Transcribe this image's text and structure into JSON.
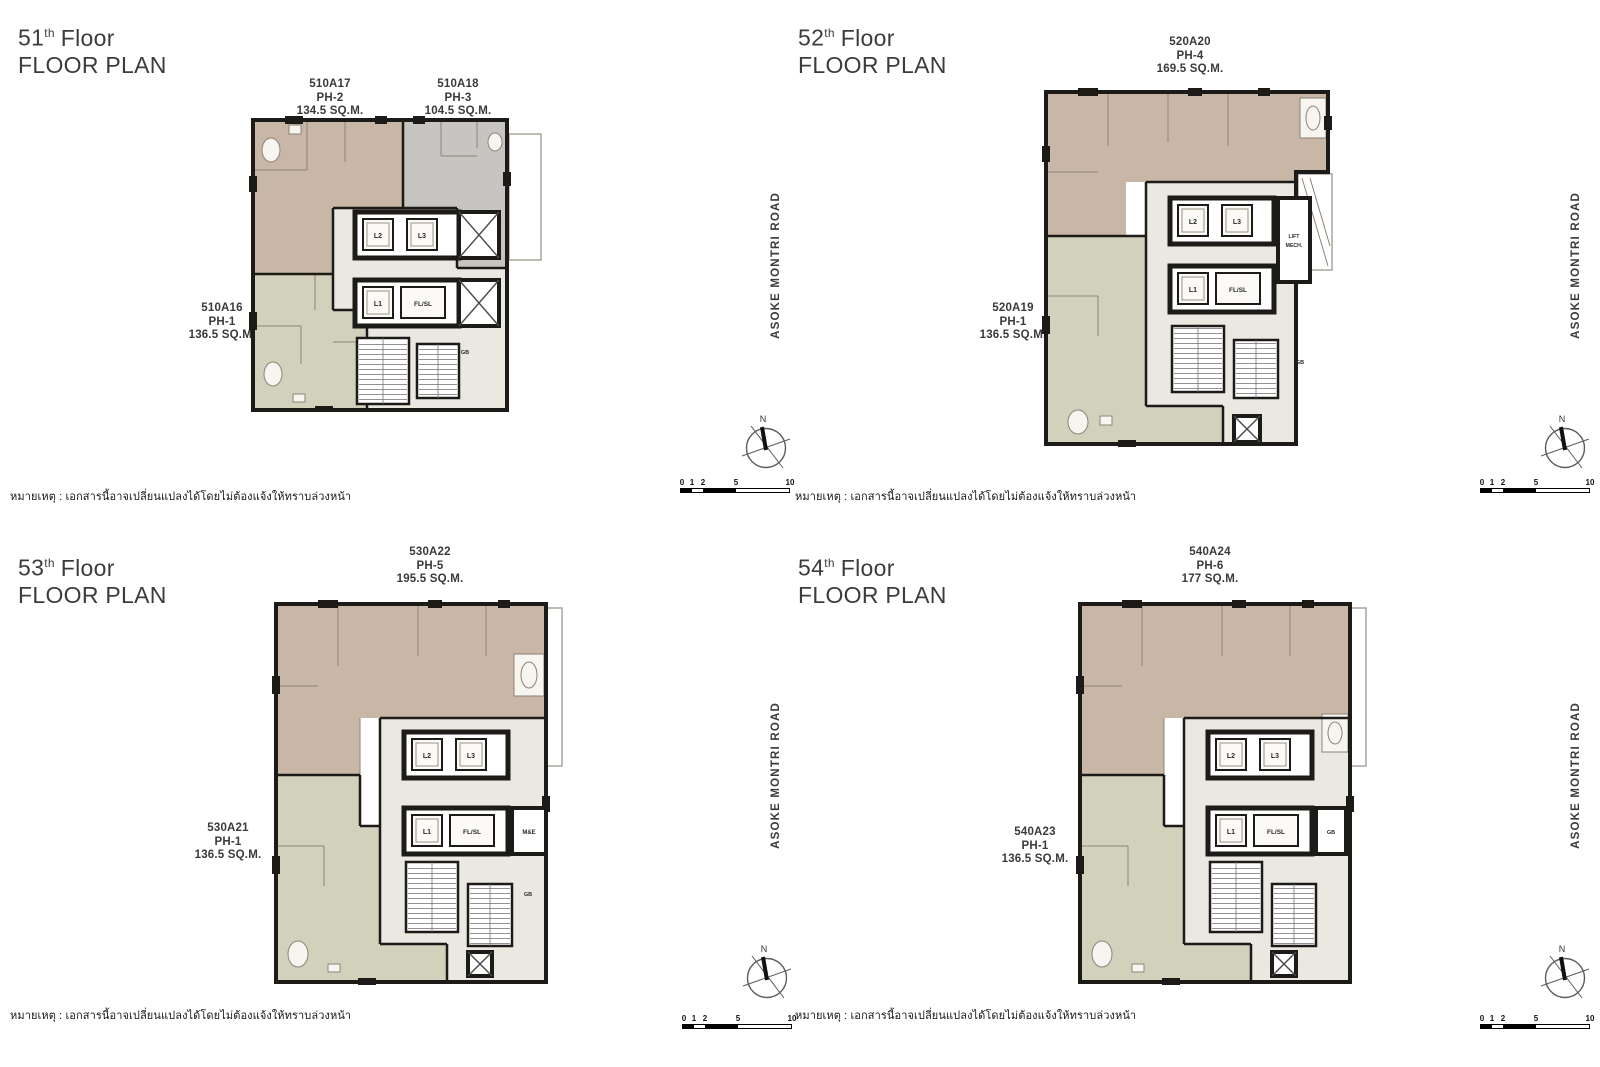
{
  "colors": {
    "beige": "#c8b7a6",
    "gray": "#c6c5c2",
    "olive": "#d2d1bc",
    "core": "#eae8e1",
    "wall": "#1d1b18"
  },
  "document": {
    "note": "หมายเหตุ : เอกสารนี้อาจเปลี่ยนแปลงได้โดยไม่ต้องแจ้งให้ทราบล่วงหน้า",
    "road_label": "ASOKE MONTRI ROAD",
    "north_label": "N"
  },
  "scale_bar": {
    "labels": [
      "0",
      "1",
      "2",
      "5",
      "10"
    ]
  },
  "floors": [
    {
      "number": "51",
      "ordinal_suffix": "th",
      "title_word": "Floor",
      "subtitle": "FLOOR PLAN",
      "units_top": [
        {
          "code": "510A17",
          "type": "PH-2",
          "area": "134.5 SQ.M."
        },
        {
          "code": "510A18",
          "type": "PH-3",
          "area": "104.5 SQ.M."
        }
      ],
      "unit_left": {
        "code": "510A16",
        "type": "PH-1",
        "area": "136.5 SQ.M."
      },
      "core": {
        "l2": "L2",
        "l3": "L3",
        "l1": "L1",
        "flsl": "FL/SL",
        "gb": "GB"
      }
    },
    {
      "number": "52",
      "ordinal_suffix": "th",
      "title_word": "Floor",
      "subtitle": "FLOOR PLAN",
      "units_top": [
        {
          "code": "520A20",
          "type": "PH-4",
          "area": "169.5 SQ.M."
        }
      ],
      "unit_left": {
        "code": "520A19",
        "type": "PH-1",
        "area": "136.5 SQ.M."
      },
      "core": {
        "l2": "L2",
        "l3": "L3",
        "l1": "L1",
        "flsl": "FL/SL",
        "lift": "LIFT",
        "mech": "MECH.",
        "gb": "GB"
      }
    },
    {
      "number": "53",
      "ordinal_suffix": "th",
      "title_word": "Floor",
      "subtitle": "FLOOR PLAN",
      "units_top": [
        {
          "code": "530A22",
          "type": "PH-5",
          "area": "195.5 SQ.M."
        }
      ],
      "unit_left": {
        "code": "530A21",
        "type": "PH-1",
        "area": "136.5 SQ.M."
      },
      "core": {
        "l2": "L2",
        "l3": "L3",
        "l1": "L1",
        "flsl": "FL/SL",
        "me": "M&E",
        "gb": "GB"
      }
    },
    {
      "number": "54",
      "ordinal_suffix": "th",
      "title_word": "Floor",
      "subtitle": "FLOOR PLAN",
      "units_top": [
        {
          "code": "540A24",
          "type": "PH-6",
          "area": "177 SQ.M."
        }
      ],
      "unit_left": {
        "code": "540A23",
        "type": "PH-1",
        "area": "136.5 SQ.M."
      },
      "core": {
        "l2": "L2",
        "l3": "L3",
        "l1": "L1",
        "flsl": "FL/SL",
        "gb": "GB"
      }
    }
  ]
}
